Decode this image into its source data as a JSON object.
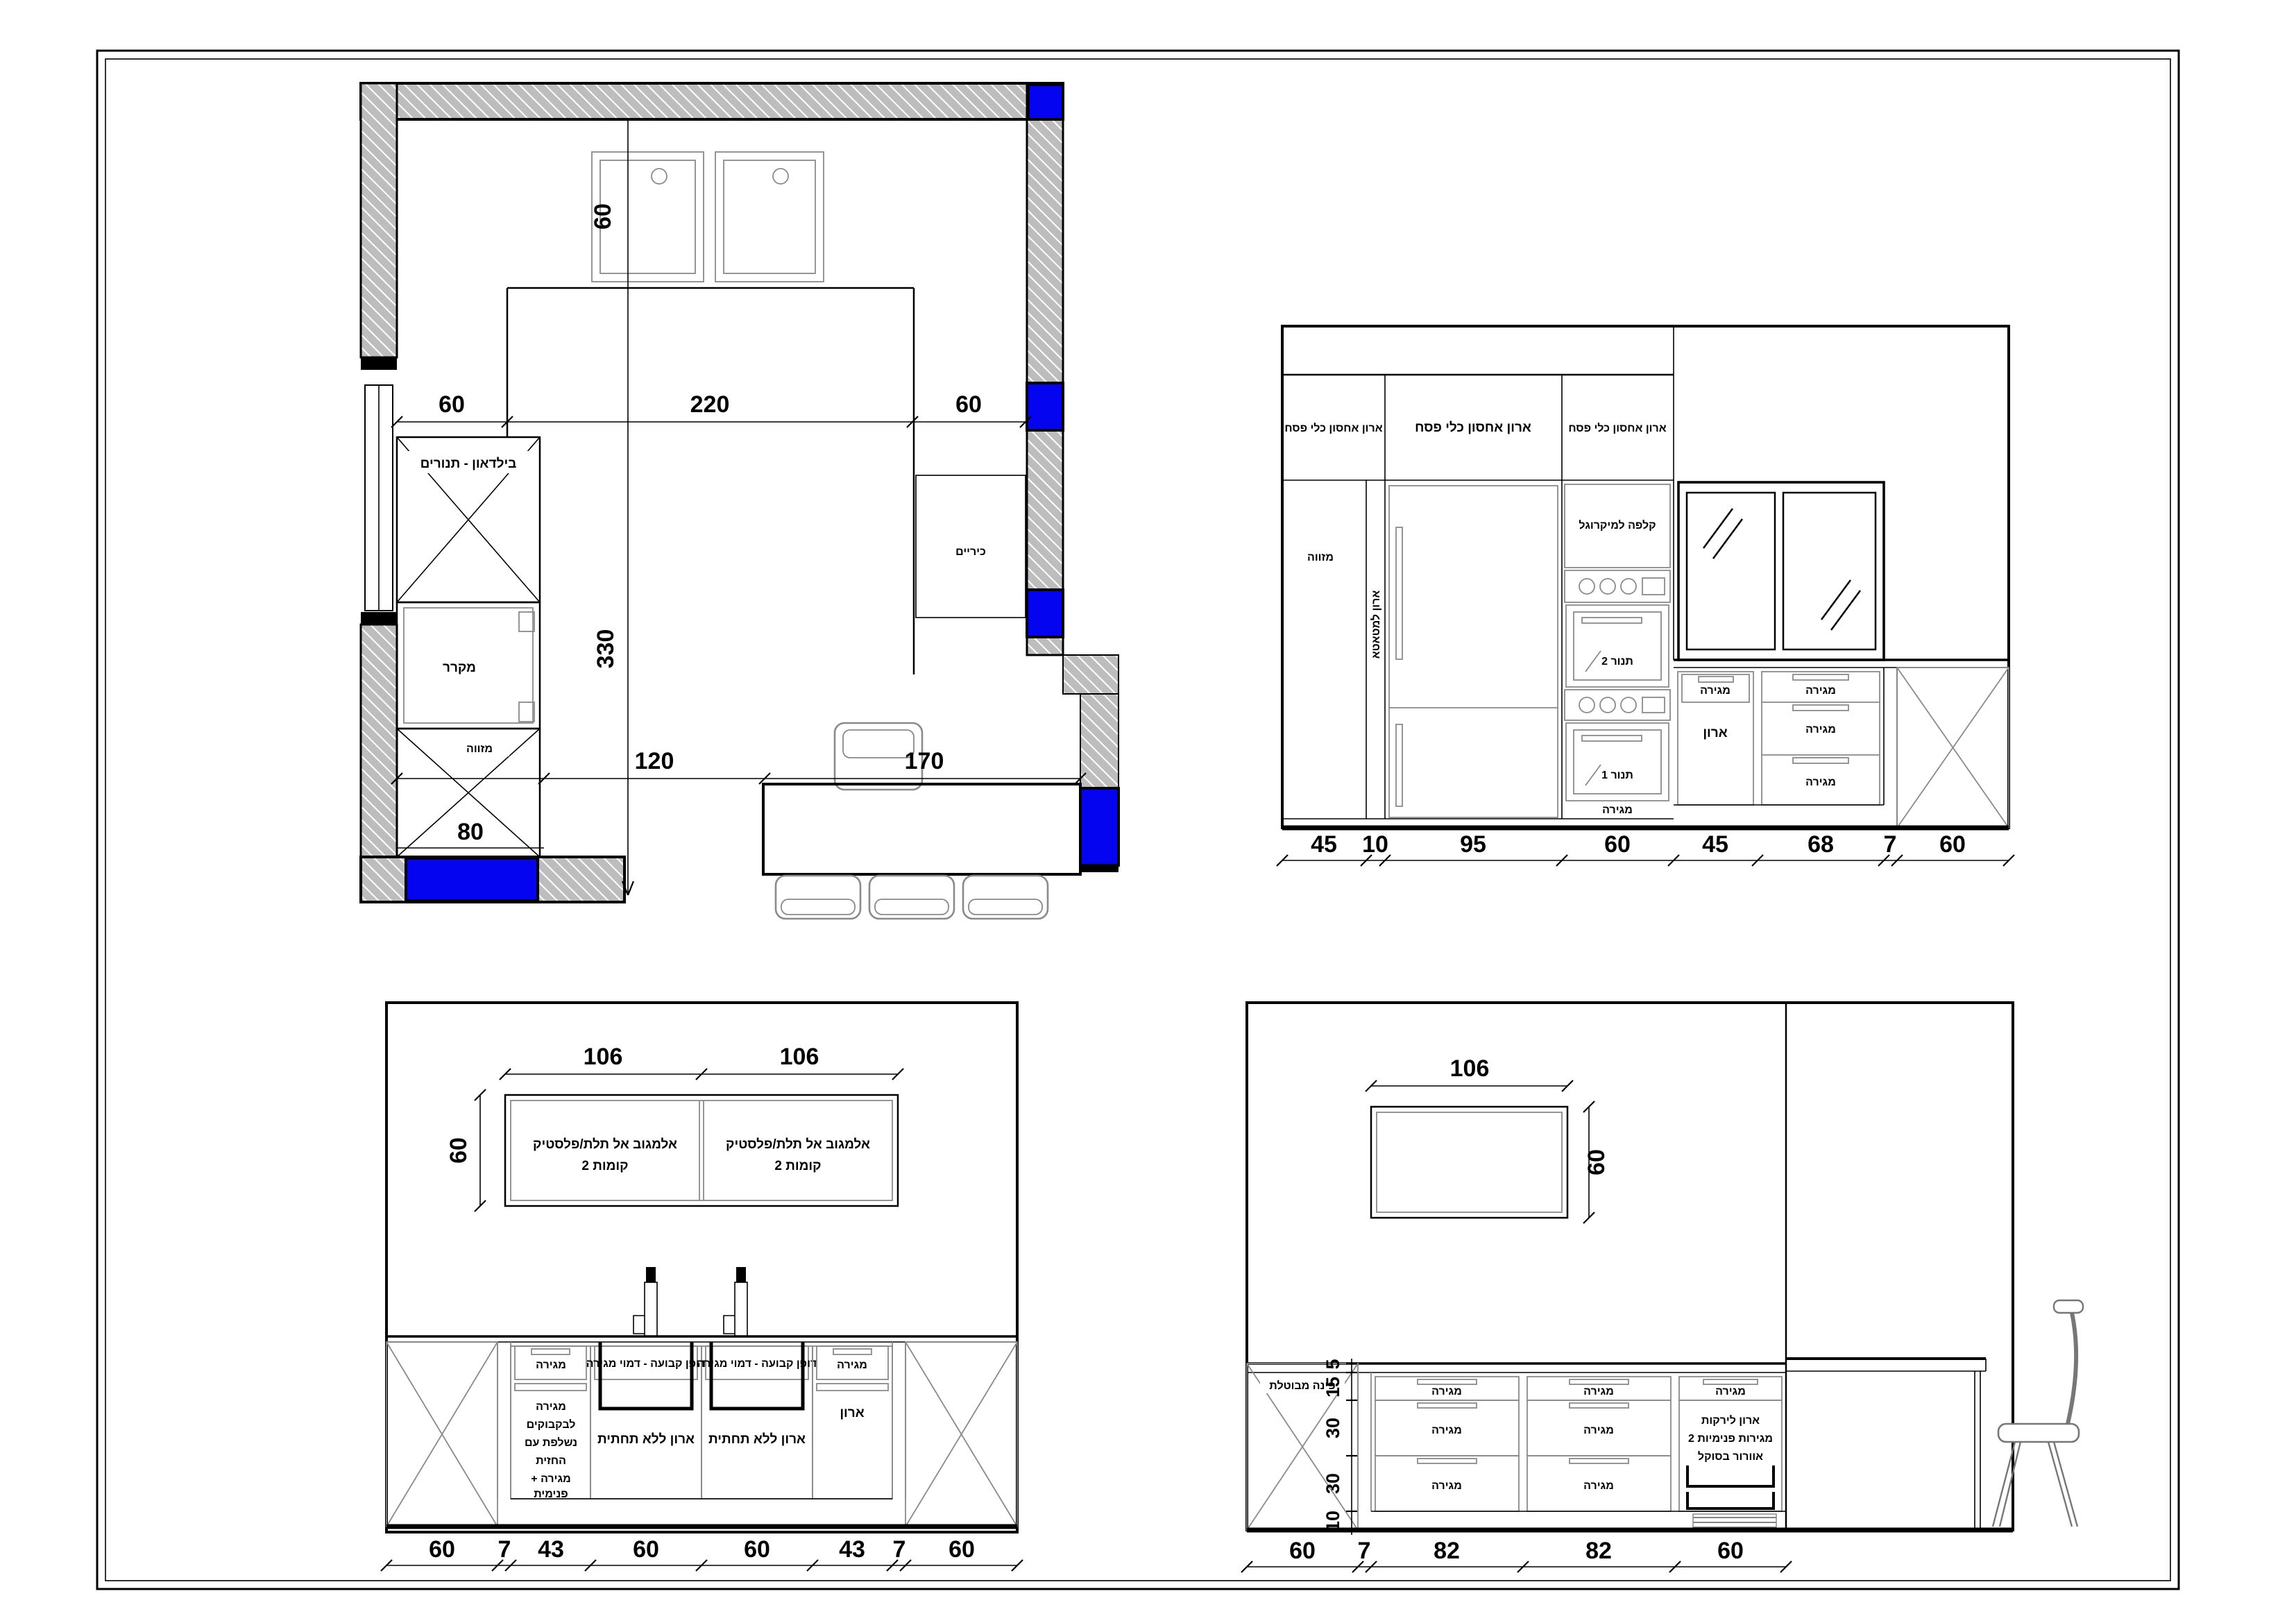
{
  "colors": {
    "accent_blue": "#0404F0"
  },
  "common": {
    "drawer": "מגירה",
    "cabinet": "ארון"
  },
  "floor_plan": {
    "ovens_niche": "בילדאון - תנורים",
    "fridge": "מקרר",
    "pantry": "מזווה",
    "cooktop": "כיריים",
    "dim_sink_depth": "60",
    "dims_top": [
      "60",
      "220",
      "60"
    ],
    "dim_depth": "330",
    "dim_pantry": "80",
    "dims_bottom": [
      "120",
      "170"
    ]
  },
  "elevation_right": {
    "pesach_cabinet": "ארון אחסון כלי פסח",
    "pantry": "מזווה",
    "broom_cabinet": "ארון למטאטא",
    "microwave_flap": "קלפה למיקרוגל",
    "oven_top": "תנור 2",
    "oven_bottom": "תנור 1",
    "dims": [
      "45",
      "10",
      "95",
      "60",
      "45",
      "68",
      "7",
      "60"
    ]
  },
  "elevation_island": {
    "wall_cabinet_line1": "אלמגוב אל תלת/פלסטיק",
    "wall_cabinet_line2": "2 קומות",
    "fixed_panel": "דופן קבועה - דמוי מגירה",
    "no_bottom_cabinet": "ארון ללא תחתית",
    "bottle_drawer_lines": [
      "מגירה",
      "לבקבוקים",
      "נשלפת עם",
      "החזית",
      "+ מגירה",
      "פנימית"
    ],
    "dim_upper": [
      "106",
      "106"
    ],
    "dim_height": "60",
    "dims": [
      "60",
      "7",
      "43",
      "60",
      "60",
      "43",
      "7",
      "60"
    ]
  },
  "elevation_corner": {
    "cancelled_corner": "פינה מבוטלת",
    "veg_cabinet_lines": [
      "ארון לירקות",
      "2 מגירות פנימיות",
      "אוורור בסוקל"
    ],
    "dim_cabinet_width": "106",
    "dim_cabinet_height": "60",
    "dims_vertical": [
      "5",
      "15",
      "30",
      "30",
      "10"
    ],
    "dims": [
      "60",
      "7",
      "82",
      "82",
      "60"
    ]
  }
}
